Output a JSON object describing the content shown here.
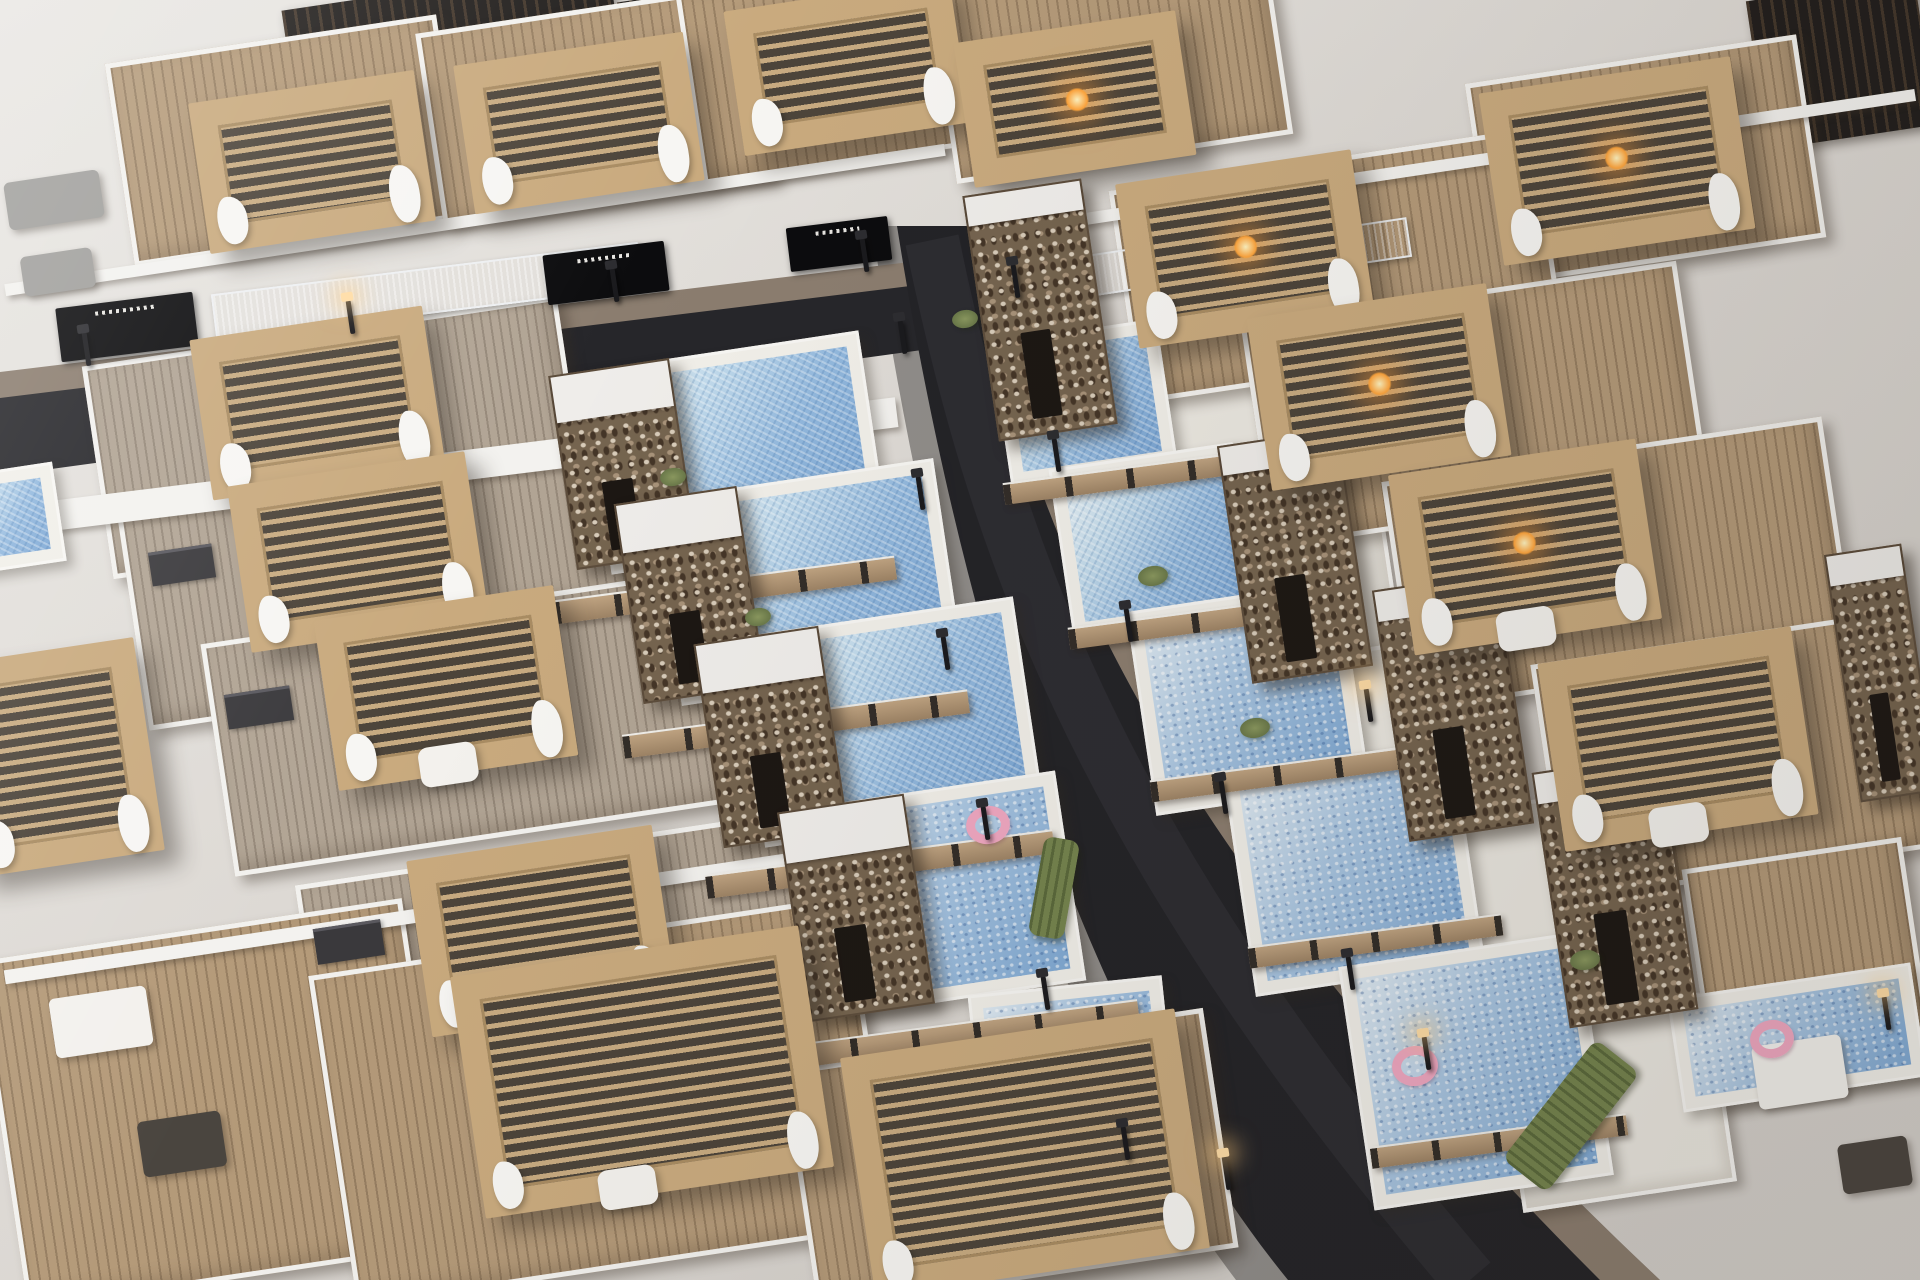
{
  "meta": {
    "title": "Aerial 3D render of modern villa development",
    "description": "Bird's-eye architectural rendering of rows of white modern villas with wooden rooftop decks, slatted timber pergolas with curtains and fire pits, pebble-stone stair towers, private blue swimming pools, wood-slat fences and a dark asphalt street with lamps curving through the development."
  },
  "palette": {
    "asphalt": "#232327",
    "sidewalk": "#908d8a",
    "paver_brown": "#8b7d6f",
    "wall_white": "#f3f2ef",
    "patio": "#ebe8e1",
    "deck_tan": "#b49a79",
    "deck_gray": "#b1a494",
    "pergola_wood": "#c9aa7e",
    "stone": "#75644f",
    "pool_light": "#e9f2f6",
    "pool_deep": "#7ba6d4",
    "fence_wood": "#c0a482",
    "hedge_green": "#75844e",
    "lamp_glow": "#ffdda6",
    "fire_glow": "#ffa53d",
    "float_pink": "#f0a8c2"
  },
  "scene": {
    "width": 1920,
    "height": 1280,
    "row_angle_deg": -8.5,
    "roads": {
      "main_sidewalk": "M872,226 L992,226 C1062,520 1182,830 1660,1280 L1236,1280 C1016,990 922,560 872,226 Z",
      "main_right_pavers": "M967,226 L992,226 C1062,520 1182,830 1660,1280 L1600,1280 C1130,810 1030,520 967,226 Z",
      "left_pavers": "M0,372 L910,262 L912,290 L0,400 Z",
      "left_asphalt": "M0,398 L910,286 L966,344 L0,476 Z",
      "main_asphalt": "M897,226 L967,226 C1030,520 1130,810 1600,1280 L1288,1280 C1060,1000 950,560 897,226 Z",
      "main_wear": "M932,240 C992,530 1086,830 1470,1280"
    },
    "elements": [
      {
        "t": "darkroof",
        "x": 285,
        "y": -14,
        "w": 330,
        "h": 72
      },
      {
        "t": "darkroof",
        "x": 620,
        "y": -20,
        "w": 300,
        "h": 64
      },
      {
        "t": "darkroof",
        "x": 1756,
        "y": -12,
        "w": 170,
        "h": 150
      },
      {
        "t": "deck",
        "v": "tan",
        "x": 118,
        "y": 38,
        "w": 335,
        "h": 205
      },
      {
        "t": "pergola",
        "x": 198,
        "y": 86,
        "w": 228,
        "h": 152,
        "f": [
          "cur"
        ]
      },
      {
        "t": "deck",
        "v": "tan",
        "x": 428,
        "y": 8,
        "w": 335,
        "h": 198
      },
      {
        "t": "pergola",
        "x": 463,
        "y": 48,
        "w": 232,
        "h": 150,
        "f": [
          "cur"
        ]
      },
      {
        "t": "deck",
        "v": "tan",
        "x": 688,
        "y": -30,
        "w": 330,
        "h": 192
      },
      {
        "t": "pergola",
        "x": 733,
        "y": -6,
        "w": 228,
        "h": 146,
        "f": [
          "cur"
        ]
      },
      {
        "t": "deck",
        "v": "tan",
        "x": 940,
        "y": -45,
        "w": 340,
        "h": 205
      },
      {
        "t": "pergola",
        "x": 963,
        "y": 26,
        "w": 224,
        "h": 146,
        "f": [
          "fire"
        ]
      },
      {
        "t": "deck",
        "v": "tan",
        "x": 1478,
        "y": 58,
        "w": 335,
        "h": 205
      },
      {
        "t": "pergola",
        "x": 1490,
        "y": 74,
        "w": 254,
        "h": 174,
        "f": [
          "fire",
          "cur"
        ]
      },
      {
        "t": "sofa",
        "v": "gray",
        "x": 6,
        "y": 176,
        "w": 96,
        "h": 48
      },
      {
        "t": "sofa",
        "v": "gray",
        "x": 22,
        "y": 252,
        "w": 72,
        "h": 40
      },
      {
        "t": "wallstrip",
        "x": 0,
        "y": 214,
        "w": 950,
        "h": 12
      },
      {
        "t": "wallstrip",
        "x": 1040,
        "y": 154,
        "w": 880,
        "h": 12
      },
      {
        "t": "garage",
        "x": 58,
        "y": 300,
        "w": 138,
        "h": 54,
        "r": -7,
        "f": [
          "sign"
        ]
      },
      {
        "t": "garage",
        "x": 545,
        "y": 248,
        "w": 122,
        "h": 50,
        "r": -7,
        "f": [
          "sign"
        ]
      },
      {
        "t": "garage",
        "x": 788,
        "y": 222,
        "w": 102,
        "h": 44,
        "r": -7,
        "f": [
          "sign"
        ]
      },
      {
        "t": "garage",
        "x": 987,
        "y": 295,
        "w": 96,
        "h": 44,
        "r": -8,
        "f": [
          "sign"
        ]
      },
      {
        "t": "lapstrip",
        "x": 212,
        "y": 268,
        "w": 430,
        "h": 46,
        "r": -7
      },
      {
        "t": "lapstrip",
        "x": 1048,
        "y": 250,
        "w": 146,
        "h": 42
      },
      {
        "t": "lapstrip",
        "x": 1260,
        "y": 228,
        "w": 150,
        "h": 40
      },
      {
        "t": "wallstrip",
        "x": 0,
        "y": 452,
        "w": 900,
        "h": 30,
        "r": -7
      },
      {
        "t": "deck",
        "v": "gray",
        "x": 95,
        "y": 330,
        "w": 480,
        "h": 215
      },
      {
        "t": "pergola",
        "x": 200,
        "y": 322,
        "w": 235,
        "h": 162,
        "f": [
          "cur"
        ]
      },
      {
        "t": "deck",
        "v": "gray",
        "x": 130,
        "y": 470,
        "w": 500,
        "h": 225
      },
      {
        "t": "pergola",
        "x": 238,
        "y": 468,
        "w": 240,
        "h": 168,
        "f": [
          "cur"
        ]
      },
      {
        "t": "deck",
        "v": "gray",
        "x": 215,
        "y": 605,
        "w": 515,
        "h": 235
      },
      {
        "t": "pergola",
        "x": 325,
        "y": 602,
        "w": 242,
        "h": 172,
        "f": [
          "cur",
          "tbl"
        ]
      },
      {
        "t": "deck",
        "v": "gray",
        "x": 310,
        "y": 845,
        "w": 530,
        "h": 245
      },
      {
        "t": "pergola",
        "x": 418,
        "y": 842,
        "w": 248,
        "h": 178,
        "f": [
          "cur"
        ]
      },
      {
        "t": "window",
        "x": 150,
        "y": 548,
        "w": 64,
        "h": 34
      },
      {
        "t": "window",
        "x": 226,
        "y": 690,
        "w": 66,
        "h": 35
      },
      {
        "t": "window",
        "x": 315,
        "y": 924,
        "w": 68,
        "h": 36
      },
      {
        "t": "tower",
        "x": 562,
        "y": 366,
        "w": 122,
        "h": 196
      },
      {
        "t": "tower",
        "x": 628,
        "y": 494,
        "w": 124,
        "h": 202
      },
      {
        "t": "tower",
        "x": 708,
        "y": 634,
        "w": 126,
        "h": 206
      },
      {
        "t": "tower",
        "x": 792,
        "y": 802,
        "w": 128,
        "h": 212
      },
      {
        "t": "poolyard",
        "x": 595,
        "y": 350,
        "w": 280,
        "h": 205
      },
      {
        "t": "poolyard",
        "x": 665,
        "y": 478,
        "w": 285,
        "h": 208
      },
      {
        "t": "poolyard",
        "x": 748,
        "y": 616,
        "w": 282,
        "h": 212
      },
      {
        "t": "poolyard",
        "v": "tex",
        "x": 820,
        "y": 788,
        "w": 252,
        "h": 212
      },
      {
        "t": "poolyard",
        "v": "tex",
        "x": 975,
        "y": 985,
        "w": 195,
        "h": 152,
        "r": -6
      },
      {
        "t": "fence",
        "x": 552,
        "y": 578,
        "w": 345,
        "h": 24,
        "r": -7.5
      },
      {
        "t": "fence",
        "x": 622,
        "y": 712,
        "w": 348,
        "h": 24,
        "r": -7.5
      },
      {
        "t": "fence",
        "x": 705,
        "y": 852,
        "w": 350,
        "h": 24,
        "r": -7.5
      },
      {
        "t": "fence",
        "x": 788,
        "y": 1022,
        "w": 352,
        "h": 24,
        "r": -7.5
      },
      {
        "t": "float",
        "x": 966,
        "y": 806,
        "w": 44,
        "h": 38
      },
      {
        "t": "plant",
        "x": 660,
        "y": 468,
        "w": 26,
        "h": 18
      },
      {
        "t": "plant",
        "x": 745,
        "y": 608,
        "w": 26,
        "h": 18
      },
      {
        "t": "plant",
        "x": 952,
        "y": 310,
        "w": 26,
        "h": 18
      },
      {
        "t": "poolyard",
        "x": -60,
        "y": 470,
        "w": 120,
        "h": 100
      },
      {
        "t": "pergola",
        "x": -40,
        "y": 650,
        "w": 190,
        "h": 215,
        "f": [
          "cur"
        ]
      },
      {
        "t": "deck",
        "v": "tan",
        "x": 0,
        "y": 928,
        "w": 430,
        "h": 352
      },
      {
        "t": "deck",
        "v": "tan",
        "x": 330,
        "y": 934,
        "w": 545,
        "h": 335
      },
      {
        "t": "pergola",
        "x": 466,
        "y": 950,
        "w": 352,
        "h": 244,
        "f": [
          "cur",
          "tbl"
        ]
      },
      {
        "t": "deck",
        "v": "tan",
        "x": 798,
        "y": 1038,
        "w": 425,
        "h": 242
      },
      {
        "t": "pergola",
        "x": 856,
        "y": 1032,
        "w": 338,
        "h": 242,
        "f": [
          "cur"
        ]
      },
      {
        "t": "sofa",
        "x": 52,
        "y": 992,
        "w": 98,
        "h": 60
      },
      {
        "t": "sofa",
        "v": "dark",
        "x": 140,
        "y": 1116,
        "w": 84,
        "h": 56
      },
      {
        "t": "wallstrip",
        "x": 0,
        "y": 906,
        "w": 870,
        "h": 14
      },
      {
        "t": "tower",
        "v": "tall",
        "x": 980,
        "y": 186,
        "w": 120,
        "h": 248
      },
      {
        "t": "tower",
        "v": "tall",
        "x": 1234,
        "y": 436,
        "w": 122,
        "h": 240
      },
      {
        "t": "tower",
        "v": "tall",
        "x": 1390,
        "y": 580,
        "w": 126,
        "h": 254
      },
      {
        "t": "tower",
        "v": "tall",
        "x": 1550,
        "y": 762,
        "w": 130,
        "h": 258
      },
      {
        "t": "tower",
        "v": "tall",
        "x": 1842,
        "y": 548,
        "w": 78,
        "h": 250
      },
      {
        "t": "poolyard",
        "x": 1000,
        "y": 330,
        "w": 168,
        "h": 146
      },
      {
        "t": "patio",
        "x": 1110,
        "y": 368,
        "w": 190,
        "h": 150
      },
      {
        "t": "poolyard",
        "x": 1060,
        "y": 455,
        "w": 186,
        "h": 170
      },
      {
        "t": "patio",
        "x": 1192,
        "y": 500,
        "w": 200,
        "h": 165
      },
      {
        "t": "poolyard",
        "v": "tex",
        "x": 1140,
        "y": 595,
        "w": 216,
        "h": 206
      },
      {
        "t": "patio",
        "x": 1288,
        "y": 645,
        "w": 205,
        "h": 172
      },
      {
        "t": "poolyard",
        "v": "tex",
        "x": 1238,
        "y": 755,
        "w": 232,
        "h": 226
      },
      {
        "t": "patio",
        "x": 1392,
        "y": 806,
        "w": 212,
        "h": 182
      },
      {
        "t": "poolyard",
        "v": "tex",
        "x": 1355,
        "y": 948,
        "w": 242,
        "h": 246
      },
      {
        "t": "patio",
        "x": 1508,
        "y": 1006,
        "w": 216,
        "h": 192
      },
      {
        "t": "poolyard",
        "v": "tex",
        "x": 1674,
        "y": 980,
        "w": 246,
        "h": 115
      },
      {
        "t": "float",
        "x": 1392,
        "y": 1046,
        "w": 46,
        "h": 40
      },
      {
        "t": "float",
        "x": 1750,
        "y": 1020,
        "w": 44,
        "h": 38
      },
      {
        "t": "fence",
        "x": 1003,
        "y": 468,
        "w": 230,
        "h": 22,
        "r": -7.5
      },
      {
        "t": "fence",
        "x": 1068,
        "y": 612,
        "w": 240,
        "h": 22,
        "r": -7.5
      },
      {
        "t": "fence",
        "x": 1150,
        "y": 764,
        "w": 250,
        "h": 22,
        "r": -7.5
      },
      {
        "t": "fence",
        "x": 1248,
        "y": 930,
        "w": 255,
        "h": 22,
        "r": -7.5
      },
      {
        "t": "fence",
        "x": 1370,
        "y": 1130,
        "w": 258,
        "h": 22,
        "r": -7.5
      },
      {
        "t": "hedge",
        "x": 1495,
        "y": 1088,
        "w": 152,
        "h": 56,
        "r": -52
      },
      {
        "t": "hedge",
        "x": 1036,
        "y": 838,
        "w": 36,
        "h": 100,
        "r": 10
      },
      {
        "t": "garage",
        "x": 1046,
        "y": 1046,
        "w": 92,
        "h": 112,
        "r": 12
      },
      {
        "t": "planter",
        "x": 1300,
        "y": 320,
        "w": 96,
        "h": 26
      },
      {
        "t": "plant",
        "x": 1138,
        "y": 566,
        "w": 30,
        "h": 20
      },
      {
        "t": "plant",
        "x": 1240,
        "y": 718,
        "w": 30,
        "h": 20
      },
      {
        "t": "plant",
        "x": 1570,
        "y": 950,
        "w": 30,
        "h": 20
      },
      {
        "t": "deck",
        "v": "tan",
        "x": 1122,
        "y": 158,
        "w": 430,
        "h": 215
      },
      {
        "t": "pergola",
        "x": 1126,
        "y": 166,
        "w": 238,
        "h": 166,
        "f": [
          "fire",
          "cur"
        ]
      },
      {
        "t": "deck",
        "v": "tan",
        "x": 1255,
        "y": 292,
        "w": 440,
        "h": 225
      },
      {
        "t": "pergola",
        "x": 1258,
        "y": 300,
        "w": 242,
        "h": 174,
        "f": [
          "fire",
          "cur"
        ]
      },
      {
        "t": "deck",
        "v": "tan",
        "x": 1396,
        "y": 448,
        "w": 445,
        "h": 232
      },
      {
        "t": "pergola",
        "x": 1400,
        "y": 456,
        "w": 250,
        "h": 182,
        "f": [
          "fire",
          "cur",
          "tbl"
        ]
      },
      {
        "t": "deck",
        "v": "tan",
        "x": 1546,
        "y": 636,
        "w": 374,
        "h": 240
      },
      {
        "t": "pergola",
        "x": 1550,
        "y": 644,
        "w": 256,
        "h": 190,
        "f": [
          "tbl",
          "cur"
        ]
      },
      {
        "t": "deck",
        "v": "tan",
        "x": 1698,
        "y": 852,
        "w": 222,
        "h": 240
      },
      {
        "t": "sofa",
        "x": 1755,
        "y": 1040,
        "w": 90,
        "h": 64
      },
      {
        "t": "sofa",
        "v": "dark",
        "x": 1840,
        "y": 1140,
        "w": 70,
        "h": 50
      },
      {
        "t": "lamp",
        "x": 84,
        "y": 332,
        "h": 34
      },
      {
        "t": "lamp",
        "x": 348,
        "y": 300,
        "h": 34,
        "f": [
          "glow"
        ]
      },
      {
        "t": "lamp",
        "x": 612,
        "y": 268,
        "h": 34
      },
      {
        "t": "lamp",
        "x": 862,
        "y": 238,
        "h": 34
      },
      {
        "t": "lamp",
        "x": 900,
        "y": 320,
        "h": 34
      },
      {
        "t": "lamp",
        "x": 918,
        "y": 476,
        "h": 34
      },
      {
        "t": "lamp",
        "x": 943,
        "y": 636,
        "h": 34
      },
      {
        "t": "lamp",
        "x": 983,
        "y": 806,
        "h": 34
      },
      {
        "t": "lamp",
        "x": 1043,
        "y": 976,
        "h": 34
      },
      {
        "t": "lamp",
        "x": 1123,
        "y": 1126,
        "h": 34
      },
      {
        "t": "lamp",
        "x": 1224,
        "y": 1156,
        "h": 34,
        "f": [
          "glow"
        ]
      },
      {
        "t": "lamp",
        "x": 1013,
        "y": 264,
        "h": 34
      },
      {
        "t": "lamp",
        "x": 1054,
        "y": 438,
        "h": 34
      },
      {
        "t": "lamp",
        "x": 1126,
        "y": 608,
        "h": 34
      },
      {
        "t": "lamp",
        "x": 1221,
        "y": 780,
        "h": 34
      },
      {
        "t": "lamp",
        "x": 1348,
        "y": 956,
        "h": 34
      },
      {
        "t": "lamp",
        "x": 1424,
        "y": 1036,
        "h": 34,
        "f": [
          "glow"
        ]
      },
      {
        "t": "lamp",
        "x": 1884,
        "y": 996,
        "h": 34,
        "f": [
          "glow"
        ]
      },
      {
        "t": "lamp",
        "x": 1366,
        "y": 688,
        "h": 34,
        "f": [
          "glow"
        ]
      }
    ]
  }
}
